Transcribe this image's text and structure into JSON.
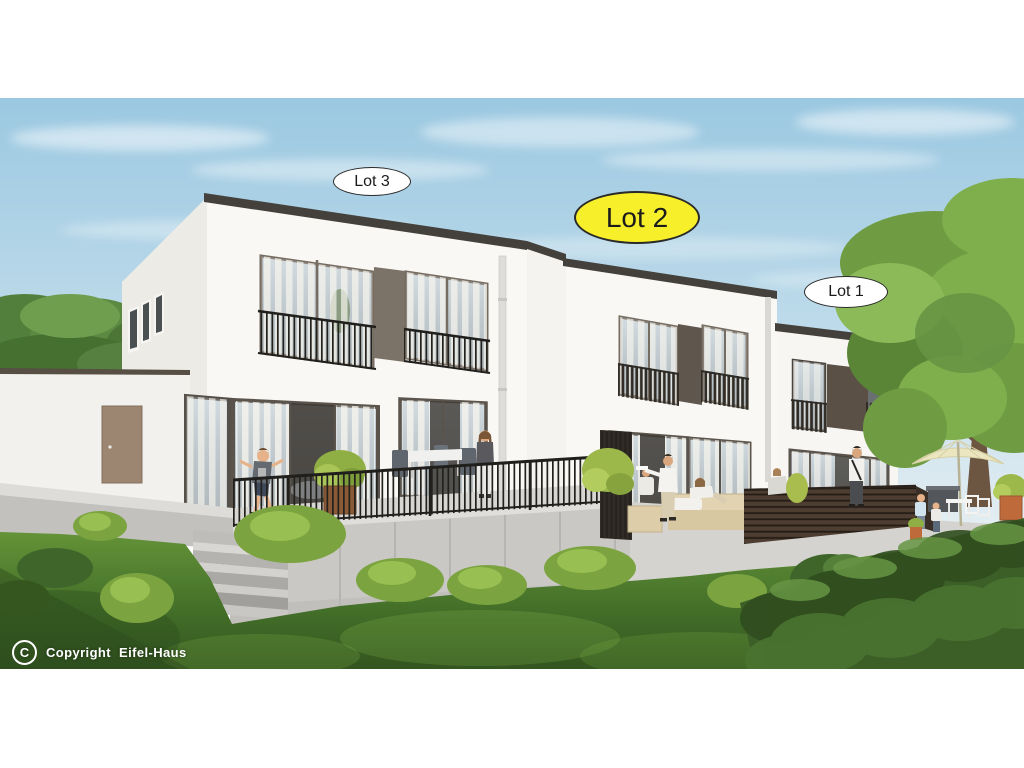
{
  "page": {
    "background": "#ffffff"
  },
  "scene": {
    "type": "architectural-rendering",
    "description": "3D exterior rendering of three modern flat-roof houses (Lot 3, Lot 2, Lot 1) with terraces, metal and wood railings, garden, lawn, trees and people"
  },
  "labels": {
    "lot3": {
      "text": "Lot 3",
      "highlighted": false
    },
    "lot2": {
      "text": "Lot 2",
      "highlighted": true
    },
    "lot1": {
      "text": "Lot 1",
      "highlighted": false
    }
  },
  "copyright": {
    "symbol": "C",
    "text": "Copyright  Eifel-Haus"
  },
  "colors": {
    "lot2_highlight": "#f7ef2a",
    "label_background": "#ffffff",
    "label_border": "#2a2a2a",
    "sky_top": "#9bc8e1",
    "sky_horizon": "#e2edf2",
    "facade_white": "#f9f8f4",
    "roof_fascia": "#44413c",
    "window_frame": "#756c62",
    "dark_panel": "#5f564d",
    "garage_door_brown": "#9c8672",
    "railing_black": "#201f1c",
    "fence_brown": "#4d3e31",
    "terrace_concrete": "#c9c8c4",
    "grass_green": "#4a7a2e",
    "foliage_green": "#6f9c42",
    "umbrella_cream": "#ece6c0",
    "planter_orange": "#bf6a3b",
    "copyright_text": "#ffffff"
  }
}
